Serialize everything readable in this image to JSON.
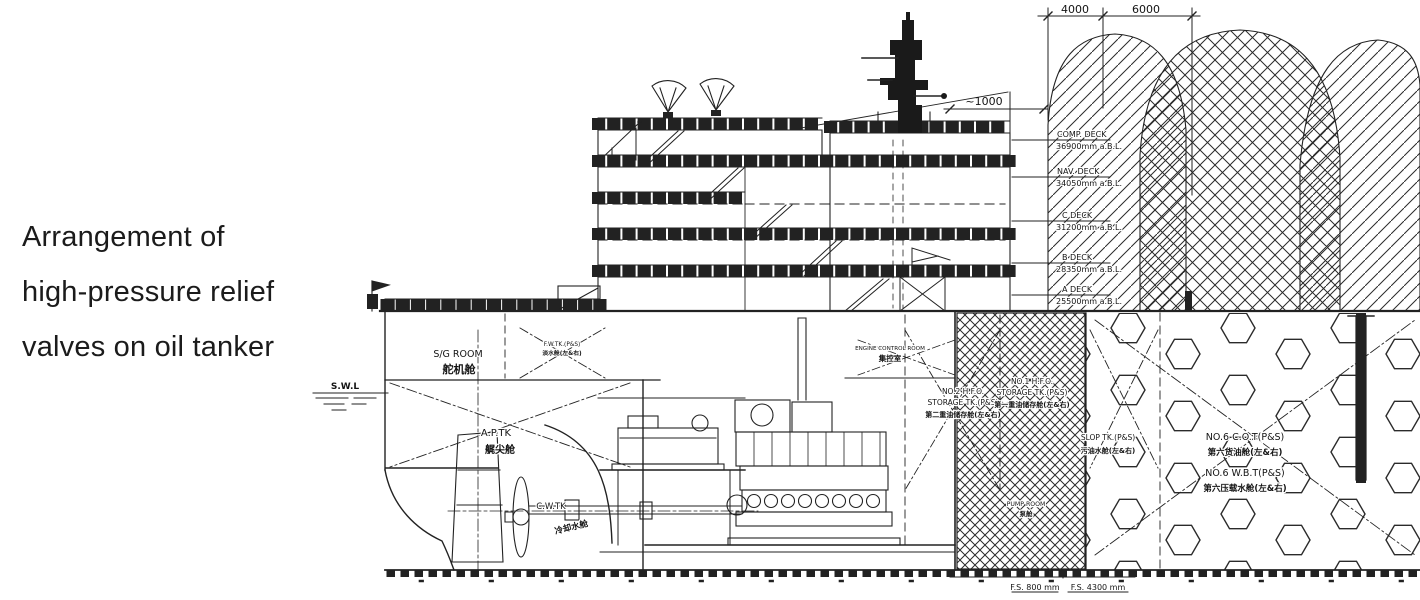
{
  "caption": {
    "line1": "Arrangement of",
    "line2": "high-pressure relief",
    "line3": "valves on oil tanker"
  },
  "dimensions": {
    "dim_left": "4000",
    "dim_right": "6000",
    "approx": "~1000",
    "fs_left": "F.S. 800 mm",
    "fs_right": "F.S. 4300 mm"
  },
  "decks": [
    {
      "name": "COMP. DECK",
      "elevation": "36900mm a.B.L."
    },
    {
      "name": "NAV. DECK",
      "elevation": "34050mm a.B.L."
    },
    {
      "name": "C DECK",
      "elevation": "31200mm a.B.L."
    },
    {
      "name": "B DECK",
      "elevation": "28350mm a.B.L."
    },
    {
      "name": "A DECK",
      "elevation": "25500mm a.B.L."
    }
  ],
  "labels": {
    "swl": "S.W.L",
    "sg_room": "S/G ROOM",
    "sg_room_cn": "舵机舱",
    "ap_tank": "A.P.TK",
    "ap_tank_cn": "艉尖舱",
    "cw_tank": "C.W.TK",
    "cw_tank_cn": "冷却水舱",
    "fw_tank": "F.W.TK.(P&S)",
    "fw_tank_cn": "淡水舱(左&右)",
    "ecr": "ENGINE CONTROL ROOM",
    "ecr_cn": "集控室",
    "no2_hfo_1": "NO.2 H.F.O.",
    "no2_hfo_2": "STORAGE TK.(P&S)",
    "no2_hfo_cn": "第二重油储存舱(左&右)",
    "no1_hfo_1": "NO.1 H.F.O.",
    "no1_hfo_2": "STORAGE TK.(P&S)",
    "no1_hfo_cn": "第一重油储存舱(左&右)",
    "pump_room": "PUMP ROOM",
    "pump_room_cn": "泵舱",
    "slop": "SLOP TK.(P&S)",
    "slop_cn": "污油水舱(左&右)",
    "no6_cot": "NO.6 C.O.T(P&S)",
    "no6_cot_cn": "第六货油舱(左&右)",
    "no6_wbt": "NO.6 W.B.T(P&S)",
    "no6_wbt_cn": "第六压载水舱(左&右)"
  },
  "colors": {
    "line": "#222222",
    "text": "#131313",
    "background": "#ffffff"
  }
}
